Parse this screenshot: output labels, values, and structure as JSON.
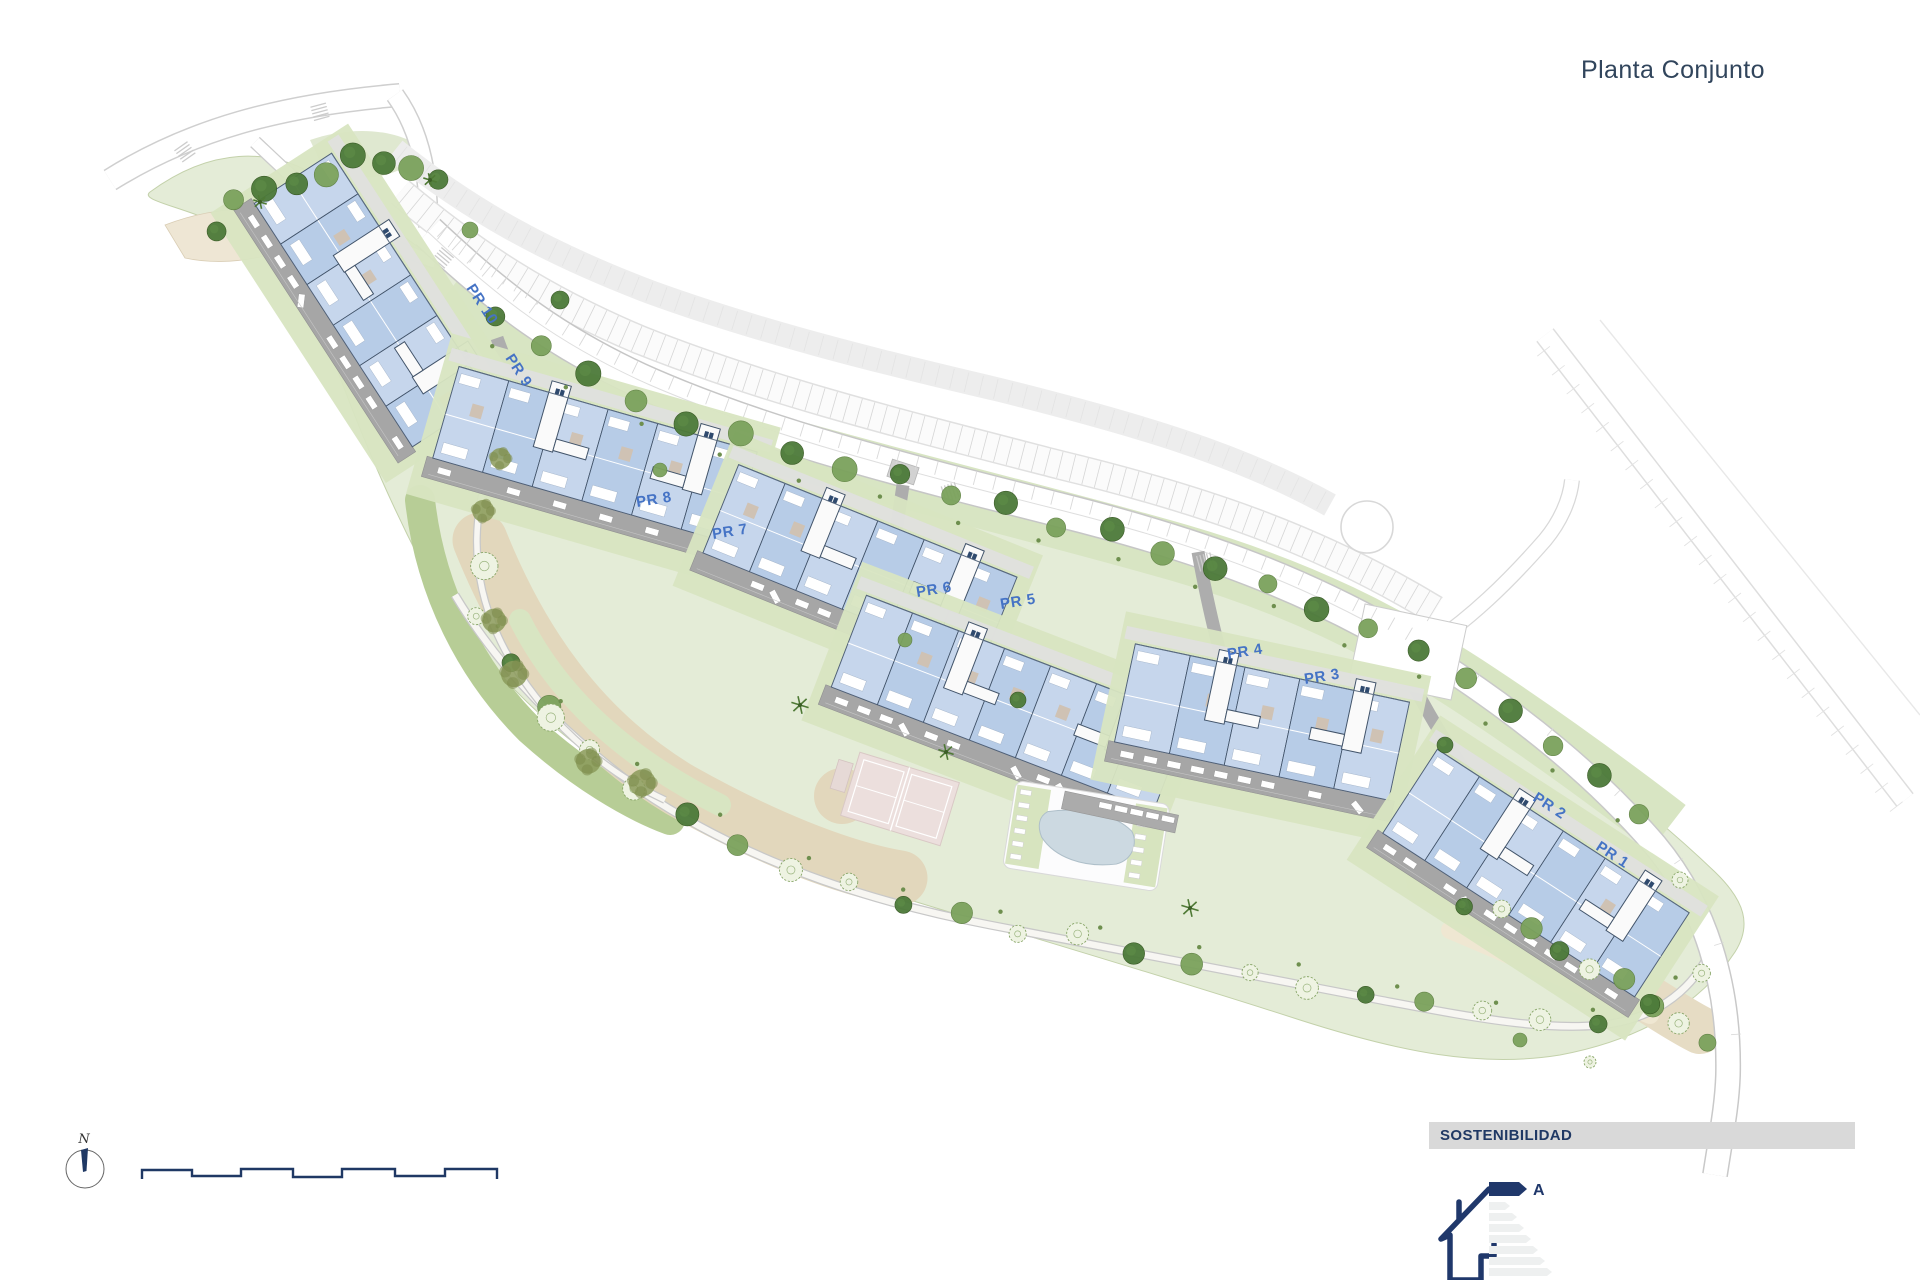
{
  "title": "Planta Conjunto",
  "compass": {
    "label": "N"
  },
  "plan": {
    "labels": [
      {
        "id": "pr-10",
        "text": "PR 10"
      },
      {
        "id": "pr-9",
        "text": "PR 9"
      },
      {
        "id": "pr-8",
        "text": "PR 8"
      },
      {
        "id": "pr-7",
        "text": "PR 7"
      },
      {
        "id": "pr-6",
        "text": "PR 6"
      },
      {
        "id": "pr-5",
        "text": "PR 5"
      },
      {
        "id": "pr-4",
        "text": "PR 4"
      },
      {
        "id": "pr-3",
        "text": "PR 3"
      },
      {
        "id": "pr-2",
        "text": "PR 2"
      },
      {
        "id": "pr-1",
        "text": "PR 1"
      }
    ],
    "label_color": "#4573c5"
  },
  "sustainability": {
    "heading": "SOSTENIBILIDAD",
    "energy_class": "A",
    "bar_background": "#d9d9d9",
    "icon_color": "#1f3864"
  },
  "colors": {
    "title_text": "#31455c",
    "navy_accent": "#1f3864",
    "site_green": "#e4ecd7",
    "strip_green": "#d8e5c3",
    "building_blue": "#bdd0e8",
    "parking_gray": "#a6a6a6",
    "sand": "#e2d7bc",
    "pool_blue": "#ccd9e1",
    "tennis_pink": "#ecdfdd"
  }
}
